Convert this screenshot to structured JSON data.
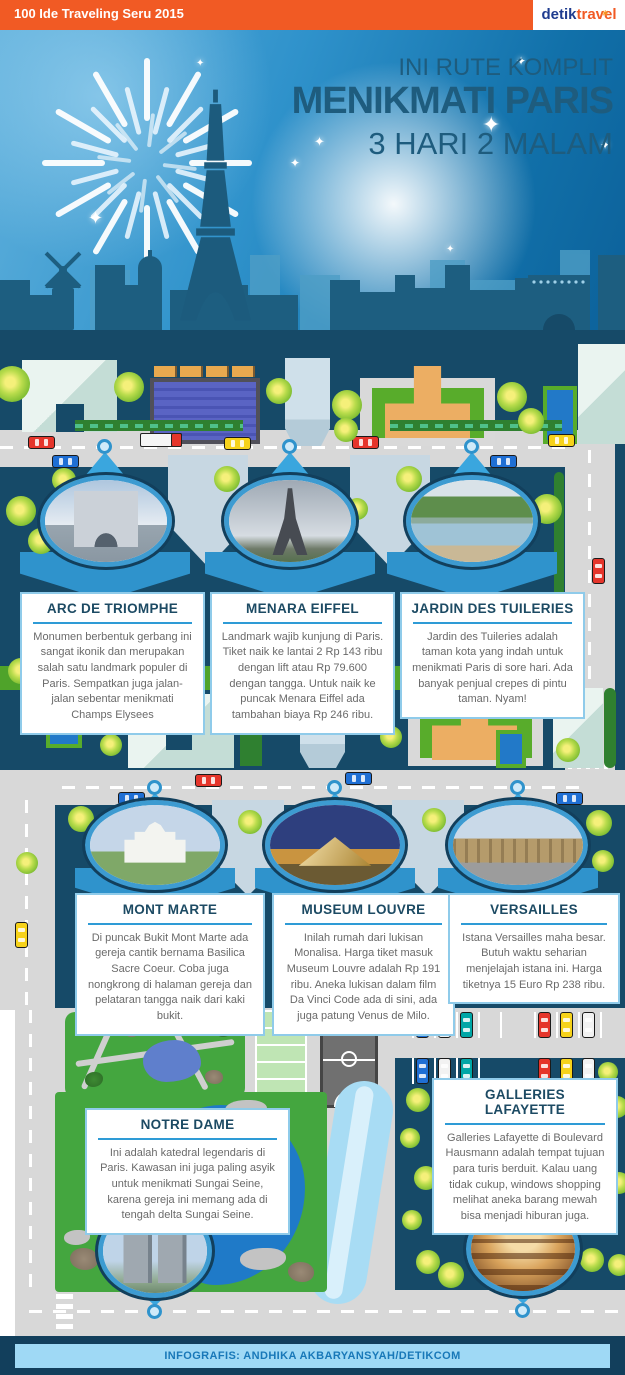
{
  "topbar": {
    "title": "100 Ide Traveling Seru 2015",
    "brand": {
      "detik": "detik",
      "travel": "travel"
    }
  },
  "header": {
    "kicker": "INI RUTE KOMPLIT",
    "title": "MENIKMATI PARIS",
    "subtitle": "3 HARI 2 MALAM"
  },
  "locations": {
    "row1": [
      {
        "title": "ARC DE TRIOMPHE",
        "body": "Monumen berbentuk gerbang ini sangat ikonik dan merupakan salah satu landmark populer di Paris. Sempatkan juga jalan-jalan sebentar menikmati Champs Elysees"
      },
      {
        "title": "MENARA EIFFEL",
        "body": "Landmark wajib kunjung di Paris. Tiket naik ke lantai 2 Rp 143 ribu dengan lift atau Rp 79.600 dengan tangga. Untuk naik ke puncak Menara Eiffel ada tambahan biaya Rp 246 ribu."
      },
      {
        "title": "JARDIN DES TUILERIES",
        "body": "Jardin des Tuileries adalah taman kota yang indah untuk menikmati Paris di sore hari. Ada banyak penjual crepes di pintu taman. Nyam!"
      }
    ],
    "row2": [
      {
        "title": "MONT MARTE",
        "body": "Di puncak Bukit Mont Marte ada gereja cantik bernama Basilica Sacre Coeur. Coba juga nongkrong di halaman gereja dan pelataran tangga naik dari kaki bukit."
      },
      {
        "title": "MUSEUM LOUVRE",
        "body": "Inilah rumah dari lukisan Monalisa. Harga tiket masuk Museum Louvre adalah Rp 191 ribu. Aneka lukisan dalam film Da Vinci Code ada di sini, ada juga patung Venus de Milo."
      },
      {
        "title": "VERSAILLES",
        "body": "Istana Versailles maha besar. Butuh waktu seharian menjelajah istana ini. Harga tiketnya 15 Euro Rp 238 ribu."
      }
    ],
    "row3": [
      {
        "title": "NOTRE DAME",
        "body": "Ini adalah katedral legendaris di Paris. Kawasan ini juga paling asyik untuk menikmati Sungai Seine, karena gereja ini memang ada di tengah delta Sungai Seine."
      },
      {
        "title": "GALLERIES LAFAYETTE",
        "body": "Galleries Lafayette di Boulevard Hausmann adalah tempat tujuan para turis berduit. Kalau uang tidak cukup, windows shopping melihat aneka barang mewah bisa menjadi hiburan juga."
      }
    ]
  },
  "footer": {
    "credit": "INFOGRAFIS: ANDHIKA AKBARYANSYAH/DETIKCOM"
  },
  "colors": {
    "topbar_orange": "#F15A24",
    "map_navy": "#164A68",
    "pin_blue": "#3AA6DE",
    "rule_blue": "#2E9BD6",
    "road_gray": "#D8D8D8",
    "tree_green": "#7FBE33",
    "footer_bar": "#9FD9F5",
    "title_navy": "#1E5C7E"
  }
}
